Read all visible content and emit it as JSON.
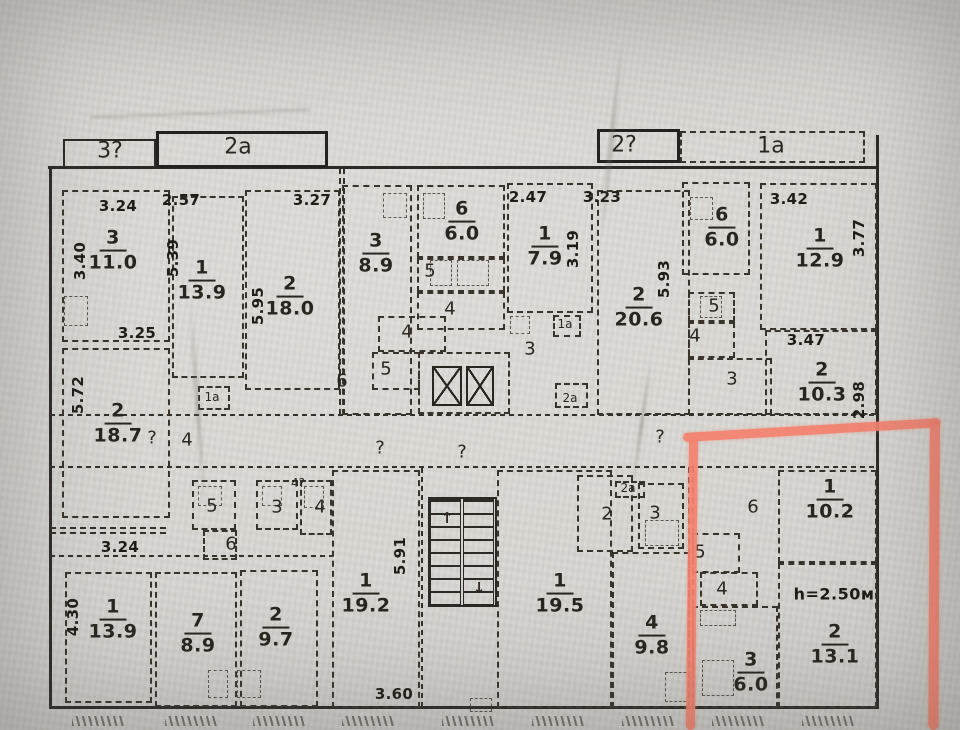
{
  "plan": {
    "bay_labels": [
      {
        "text": "3?",
        "x": 110,
        "y": 151
      },
      {
        "text": "2а",
        "x": 238,
        "y": 147
      },
      {
        "text": "2?",
        "x": 624,
        "y": 145
      },
      {
        "text": "1а",
        "x": 771,
        "y": 146
      }
    ],
    "rooms": [
      {
        "num": "3",
        "area": "11.0",
        "x": 113,
        "y": 251
      },
      {
        "num": "1",
        "area": "13.9",
        "x": 202,
        "y": 281
      },
      {
        "num": "2",
        "area": "18.0",
        "x": 290,
        "y": 297
      },
      {
        "num": "3",
        "area": "8.9",
        "x": 376,
        "y": 254
      },
      {
        "num": "6",
        "area": "6.0",
        "x": 462,
        "y": 222
      },
      {
        "num": "1",
        "area": "7.9",
        "x": 545,
        "y": 247
      },
      {
        "num": "2",
        "area": "20.6",
        "x": 639,
        "y": 308
      },
      {
        "num": "6",
        "area": "6.0",
        "x": 722,
        "y": 228
      },
      {
        "num": "1",
        "area": "12.9",
        "x": 820,
        "y": 249
      },
      {
        "num": "2",
        "area": "10.3",
        "x": 822,
        "y": 383
      },
      {
        "num": "2",
        "area": "18.7",
        "x": 118,
        "y": 424
      },
      {
        "num": "1",
        "area": "13.9",
        "x": 113,
        "y": 620
      },
      {
        "num": "7",
        "area": "8.9",
        "x": 198,
        "y": 634
      },
      {
        "num": "2",
        "area": "9.7",
        "x": 276,
        "y": 628
      },
      {
        "num": "1",
        "area": "19.2",
        "x": 366,
        "y": 594
      },
      {
        "num": "1",
        "area": "19.5",
        "x": 560,
        "y": 594
      },
      {
        "num": "4",
        "area": "9.8",
        "x": 652,
        "y": 636
      },
      {
        "num": "1",
        "area": "10.2",
        "x": 830,
        "y": 500
      },
      {
        "num": "2",
        "area": "13.1",
        "x": 835,
        "y": 645
      },
      {
        "num": "3",
        "area": "6.0",
        "x": 751,
        "y": 673
      }
    ],
    "dims": [
      {
        "text": "3.24",
        "x": 118,
        "y": 206,
        "vert": false
      },
      {
        "text": "3.40",
        "x": 80,
        "y": 261,
        "vert": true
      },
      {
        "text": "2.57",
        "x": 181,
        "y": 200,
        "vert": false
      },
      {
        "text": "5.39",
        "x": 173,
        "y": 258,
        "vert": true
      },
      {
        "text": "3.27",
        "x": 312,
        "y": 200,
        "vert": false
      },
      {
        "text": "5.95",
        "x": 258,
        "y": 306,
        "vert": true
      },
      {
        "text": "2.47",
        "x": 528,
        "y": 197,
        "vert": false
      },
      {
        "text": "3.23",
        "x": 602,
        "y": 197,
        "vert": false
      },
      {
        "text": "3.19",
        "x": 573,
        "y": 249,
        "vert": true
      },
      {
        "text": "5.93",
        "x": 664,
        "y": 279,
        "vert": true
      },
      {
        "text": "3.42",
        "x": 789,
        "y": 199,
        "vert": false
      },
      {
        "text": "3.77",
        "x": 859,
        "y": 238,
        "vert": true
      },
      {
        "text": "3.25",
        "x": 137,
        "y": 333,
        "vert": false
      },
      {
        "text": "5.72",
        "x": 78,
        "y": 395,
        "vert": true
      },
      {
        "text": "3.47",
        "x": 806,
        "y": 340,
        "vert": false
      },
      {
        "text": "2.98",
        "x": 859,
        "y": 400,
        "vert": true
      },
      {
        "text": "3.24",
        "x": 120,
        "y": 547,
        "vert": false
      },
      {
        "text": "4.30",
        "x": 73,
        "y": 617,
        "vert": true
      },
      {
        "text": "5.91",
        "x": 400,
        "y": 556,
        "vert": true
      },
      {
        "text": "3.60",
        "x": 394,
        "y": 694,
        "vert": false
      }
    ],
    "labels": [
      {
        "text": "?",
        "x": 152,
        "y": 438
      },
      {
        "text": "4",
        "x": 187,
        "y": 440
      },
      {
        "text": "1а",
        "x": 212,
        "y": 397,
        "sz": 12
      },
      {
        "text": "6",
        "x": 342,
        "y": 381
      },
      {
        "text": "4",
        "x": 407,
        "y": 332
      },
      {
        "text": "5",
        "x": 386,
        "y": 369
      },
      {
        "text": "5",
        "x": 430,
        "y": 271
      },
      {
        "text": "4",
        "x": 450,
        "y": 309
      },
      {
        "text": "3",
        "x": 530,
        "y": 349
      },
      {
        "text": "1а",
        "x": 565,
        "y": 324,
        "sz": 12
      },
      {
        "text": "2а",
        "x": 570,
        "y": 398,
        "sz": 12
      },
      {
        "text": "?",
        "x": 380,
        "y": 448
      },
      {
        "text": "?",
        "x": 462,
        "y": 452
      },
      {
        "text": "?",
        "x": 660,
        "y": 437
      },
      {
        "text": "5",
        "x": 714,
        "y": 306
      },
      {
        "text": "4",
        "x": 695,
        "y": 336
      },
      {
        "text": "3",
        "x": 732,
        "y": 379
      },
      {
        "text": "5",
        "x": 212,
        "y": 506
      },
      {
        "text": "6",
        "x": 231,
        "y": 544
      },
      {
        "text": "3",
        "x": 277,
        "y": 507
      },
      {
        "text": "4",
        "x": 320,
        "y": 507
      },
      {
        "text": "4?",
        "x": 298,
        "y": 483,
        "sz": 12
      },
      {
        "text": "2",
        "x": 607,
        "y": 514
      },
      {
        "text": "2а",
        "x": 628,
        "y": 488,
        "sz": 12
      },
      {
        "text": "3",
        "x": 655,
        "y": 513
      },
      {
        "text": "6",
        "x": 753,
        "y": 507
      },
      {
        "text": "5",
        "x": 700,
        "y": 552
      },
      {
        "text": "4",
        "x": 722,
        "y": 589
      }
    ],
    "stair_arrows": [
      {
        "glyph": "↑",
        "x": 447,
        "y": 518
      },
      {
        "glyph": "↓",
        "x": 479,
        "y": 588
      }
    ],
    "height_note": {
      "text": "h=2.50м",
      "x": 834,
      "y": 594
    },
    "geometry": {
      "walls": [
        {
          "x": 49,
          "y": 168,
          "w": 2.5,
          "h": 541,
          "k": "s"
        },
        {
          "x": 876,
          "y": 135,
          "w": 3,
          "h": 574,
          "k": "s"
        },
        {
          "x": 48,
          "y": 166,
          "w": 831,
          "h": 2.5,
          "k": "s"
        },
        {
          "x": 49,
          "y": 706,
          "w": 830,
          "h": 3,
          "k": "s"
        },
        {
          "x": 50,
          "y": 414,
          "w": 826,
          "h": 2,
          "k": "dh"
        },
        {
          "x": 50,
          "y": 466,
          "w": 826,
          "h": 2,
          "k": "dh"
        },
        {
          "x": 339,
          "y": 168,
          "w": 6,
          "h": 247,
          "k": "d2v"
        },
        {
          "x": 688,
          "y": 467,
          "w": 6,
          "h": 240,
          "k": "d2v"
        },
        {
          "x": 421,
          "y": 467,
          "w": 2,
          "h": 240,
          "k": "dv"
        },
        {
          "x": 50,
          "y": 527,
          "w": 116,
          "h": 7,
          "k": "d2h"
        },
        {
          "x": 50,
          "y": 555,
          "w": 282,
          "h": 2,
          "k": "dh"
        }
      ],
      "boxes": [
        {
          "x": 63,
          "y": 139,
          "w": 93,
          "h": 29,
          "k": "bs"
        },
        {
          "x": 156,
          "y": 131,
          "w": 172,
          "h": 37,
          "k": "bs2"
        },
        {
          "x": 597,
          "y": 129,
          "w": 83,
          "h": 34,
          "k": "bs2"
        },
        {
          "x": 680,
          "y": 131,
          "w": 185,
          "h": 32
        },
        {
          "x": 62,
          "y": 190,
          "w": 108,
          "h": 152
        },
        {
          "x": 172,
          "y": 196,
          "w": 72,
          "h": 182
        },
        {
          "x": 245,
          "y": 190,
          "w": 95,
          "h": 200
        },
        {
          "x": 342,
          "y": 185,
          "w": 70,
          "h": 230
        },
        {
          "x": 417,
          "y": 185,
          "w": 88,
          "h": 73
        },
        {
          "x": 417,
          "y": 258,
          "w": 88,
          "h": 34
        },
        {
          "x": 417,
          "y": 292,
          "w": 88,
          "h": 38
        },
        {
          "x": 418,
          "y": 352,
          "w": 92,
          "h": 62
        },
        {
          "x": 507,
          "y": 183,
          "w": 86,
          "h": 130
        },
        {
          "x": 597,
          "y": 190,
          "w": 93,
          "h": 225
        },
        {
          "x": 682,
          "y": 182,
          "w": 68,
          "h": 93
        },
        {
          "x": 688,
          "y": 292,
          "w": 47,
          "h": 30
        },
        {
          "x": 688,
          "y": 322,
          "w": 47,
          "h": 36
        },
        {
          "x": 688,
          "y": 358,
          "w": 84,
          "h": 57
        },
        {
          "x": 760,
          "y": 183,
          "w": 117,
          "h": 147
        },
        {
          "x": 765,
          "y": 330,
          "w": 112,
          "h": 85
        },
        {
          "x": 62,
          "y": 348,
          "w": 108,
          "h": 170
        },
        {
          "x": 378,
          "y": 316,
          "w": 68,
          "h": 36
        },
        {
          "x": 372,
          "y": 352,
          "w": 48,
          "h": 38
        },
        {
          "x": 553,
          "y": 315,
          "w": 28,
          "h": 22
        },
        {
          "x": 555,
          "y": 383,
          "w": 33,
          "h": 25
        },
        {
          "x": 198,
          "y": 386,
          "w": 32,
          "h": 24
        },
        {
          "x": 615,
          "y": 481,
          "w": 30,
          "h": 17
        },
        {
          "x": 65,
          "y": 572,
          "w": 87,
          "h": 131
        },
        {
          "x": 155,
          "y": 572,
          "w": 82,
          "h": 135
        },
        {
          "x": 240,
          "y": 570,
          "w": 78,
          "h": 137
        },
        {
          "x": 332,
          "y": 470,
          "w": 88,
          "h": 238
        },
        {
          "x": 192,
          "y": 480,
          "w": 44,
          "h": 50
        },
        {
          "x": 256,
          "y": 480,
          "w": 42,
          "h": 50
        },
        {
          "x": 300,
          "y": 480,
          "w": 32,
          "h": 55
        },
        {
          "x": 203,
          "y": 530,
          "w": 34,
          "h": 30
        },
        {
          "x": 428,
          "y": 497,
          "w": 69,
          "h": 110,
          "k": "bs"
        },
        {
          "x": 497,
          "y": 470,
          "w": 115,
          "h": 238
        },
        {
          "x": 577,
          "y": 475,
          "w": 56,
          "h": 77
        },
        {
          "x": 638,
          "y": 483,
          "w": 46,
          "h": 66
        },
        {
          "x": 612,
          "y": 552,
          "w": 78,
          "h": 156
        },
        {
          "x": 778,
          "y": 470,
          "w": 99,
          "h": 93
        },
        {
          "x": 778,
          "y": 563,
          "w": 99,
          "h": 145
        },
        {
          "x": 692,
          "y": 533,
          "w": 48,
          "h": 40
        },
        {
          "x": 700,
          "y": 572,
          "w": 58,
          "h": 34
        },
        {
          "x": 692,
          "y": 606,
          "w": 86,
          "h": 102
        }
      ],
      "fixtures": [
        {
          "x": 383,
          "y": 193,
          "w": 24,
          "h": 25
        },
        {
          "x": 423,
          "y": 193,
          "w": 22,
          "h": 26
        },
        {
          "x": 690,
          "y": 197,
          "w": 23,
          "h": 23
        },
        {
          "x": 700,
          "y": 296,
          "w": 22,
          "h": 22
        },
        {
          "x": 510,
          "y": 316,
          "w": 20,
          "h": 18
        },
        {
          "x": 64,
          "y": 296,
          "w": 24,
          "h": 30
        },
        {
          "x": 208,
          "y": 670,
          "w": 20,
          "h": 28
        },
        {
          "x": 237,
          "y": 670,
          "w": 24,
          "h": 28
        },
        {
          "x": 198,
          "y": 486,
          "w": 24,
          "h": 20
        },
        {
          "x": 262,
          "y": 486,
          "w": 20,
          "h": 20
        },
        {
          "x": 304,
          "y": 486,
          "w": 20,
          "h": 22
        },
        {
          "x": 645,
          "y": 520,
          "w": 34,
          "h": 26
        },
        {
          "x": 665,
          "y": 672,
          "w": 26,
          "h": 30
        },
        {
          "x": 700,
          "y": 610,
          "w": 36,
          "h": 16
        },
        {
          "x": 702,
          "y": 660,
          "w": 32,
          "h": 36
        },
        {
          "x": 470,
          "y": 698,
          "w": 22,
          "h": 14
        },
        {
          "x": 430,
          "y": 260,
          "w": 22,
          "h": 26
        },
        {
          "x": 457,
          "y": 260,
          "w": 32,
          "h": 26
        }
      ],
      "hatches": [
        72,
        165,
        253,
        342,
        442,
        532,
        622,
        712,
        802
      ],
      "elevator": {
        "shafts": [
          {
            "x": 432,
            "y": 366,
            "w": 30,
            "h": 40
          },
          {
            "x": 466,
            "y": 366,
            "w": 28,
            "h": 40
          }
        ]
      },
      "staircase": {
        "flights": [
          {
            "x": 430,
            "y": 499,
            "w": 31,
            "h": 106
          },
          {
            "x": 463,
            "y": 499,
            "w": 31,
            "h": 106
          }
        ]
      }
    }
  },
  "highlight": {
    "color": "#f5826f",
    "bars": [
      {
        "name": "highlight-line-left",
        "x": 689,
        "y": 438,
        "w": 9,
        "h": 292,
        "rot": 0.6,
        "origin": "top left"
      },
      {
        "name": "highlight-line-top",
        "x": 683,
        "y": 433,
        "w": 258,
        "h": 9,
        "rot": -3.3,
        "origin": "left center"
      },
      {
        "name": "highlight-line-right",
        "x": 930,
        "y": 419,
        "w": 10,
        "h": 311,
        "rot": 0.3,
        "origin": "top left"
      }
    ]
  }
}
